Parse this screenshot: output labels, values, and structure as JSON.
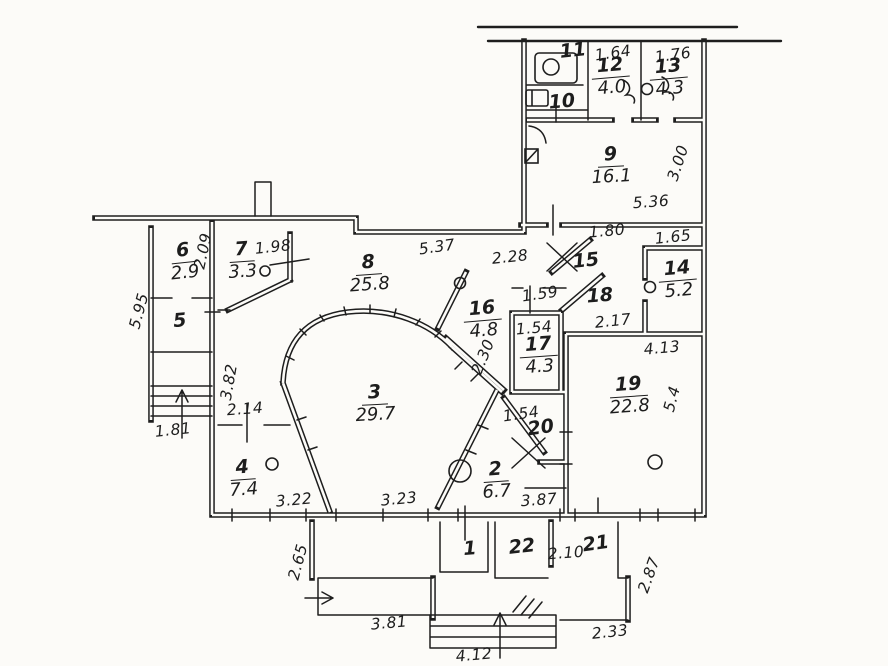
{
  "drawing": {
    "type": "apartment floor plan, hand-drawn ink on paper",
    "colors": {
      "ink": "#1e1e1e",
      "paper": "#fcfbf8"
    }
  },
  "rooms": [
    {
      "number": "1",
      "area": "",
      "x": 470,
      "y": 550,
      "rot": -4
    },
    {
      "number": "2",
      "area": "6.7",
      "x": 496,
      "y": 481,
      "rot": -4
    },
    {
      "number": "3",
      "area": "29.7",
      "x": 375,
      "y": 404,
      "rot": -3
    },
    {
      "number": "4",
      "area": "7.4",
      "x": 243,
      "y": 479,
      "rot": -4
    },
    {
      "number": "5",
      "area": "",
      "x": 180,
      "y": 322,
      "rot": -5
    },
    {
      "number": "6",
      "area": "2.9",
      "x": 184,
      "y": 262,
      "rot": -6
    },
    {
      "number": "7",
      "area": "3.3",
      "x": 242,
      "y": 261,
      "rot": -4
    },
    {
      "number": "8",
      "area": "25.8",
      "x": 369,
      "y": 274,
      "rot": -4
    },
    {
      "number": "9",
      "area": "16.1",
      "x": 611,
      "y": 166,
      "rot": -3
    },
    {
      "number": "10",
      "area": "",
      "x": 562,
      "y": 103,
      "rot": -5
    },
    {
      "number": "11",
      "area": "",
      "x": 573,
      "y": 52,
      "rot": -6
    },
    {
      "number": "12",
      "area": "4.0",
      "x": 611,
      "y": 77,
      "rot": -5
    },
    {
      "number": "13",
      "area": "4.3",
      "x": 669,
      "y": 78,
      "rot": -5
    },
    {
      "number": "14",
      "area": "5.2",
      "x": 678,
      "y": 280,
      "rot": -5
    },
    {
      "number": "15",
      "area": "",
      "x": 586,
      "y": 262,
      "rot": -6
    },
    {
      "number": "16",
      "area": "4.8",
      "x": 483,
      "y": 320,
      "rot": -5
    },
    {
      "number": "17",
      "area": "4.3",
      "x": 539,
      "y": 356,
      "rot": -4
    },
    {
      "number": "18",
      "area": "",
      "x": 600,
      "y": 297,
      "rot": -4
    },
    {
      "number": "19",
      "area": "22.8",
      "x": 629,
      "y": 396,
      "rot": -4
    },
    {
      "number": "20",
      "area": "",
      "x": 541,
      "y": 429,
      "rot": -8
    },
    {
      "number": "21",
      "area": "",
      "x": 596,
      "y": 545,
      "rot": -8
    },
    {
      "number": "22",
      "area": "",
      "x": 522,
      "y": 548,
      "rot": -6
    },
    {
      "number": "22",
      "area": "",
      "x": 0,
      "y": -99,
      "rot": 0
    }
  ],
  "dimensions": [
    {
      "text": "1.64",
      "x": 613,
      "y": 53,
      "rot": -8
    },
    {
      "text": "1.76",
      "x": 673,
      "y": 55,
      "rot": -8
    },
    {
      "text": "5.36",
      "x": 651,
      "y": 202,
      "rot": -4
    },
    {
      "text": "3.00",
      "x": 678,
      "y": 163,
      "rot": -72
    },
    {
      "text": "1.80",
      "x": 607,
      "y": 231,
      "rot": -5
    },
    {
      "text": "1.65",
      "x": 673,
      "y": 237,
      "rot": -6
    },
    {
      "text": "5.37",
      "x": 437,
      "y": 247,
      "rot": -8
    },
    {
      "text": "2.28",
      "x": 510,
      "y": 257,
      "rot": -6
    },
    {
      "text": "1.98",
      "x": 273,
      "y": 247,
      "rot": -6
    },
    {
      "text": "2.09",
      "x": 203,
      "y": 251,
      "rot": -78
    },
    {
      "text": "5.95",
      "x": 139,
      "y": 311,
      "rot": -75
    },
    {
      "text": "3.82",
      "x": 229,
      "y": 382,
      "rot": -80
    },
    {
      "text": "1.81",
      "x": 173,
      "y": 430,
      "rot": -6
    },
    {
      "text": "2.14",
      "x": 245,
      "y": 409,
      "rot": -4
    },
    {
      "text": "3.22",
      "x": 294,
      "y": 500,
      "rot": -5
    },
    {
      "text": "3.23",
      "x": 399,
      "y": 499,
      "rot": -5
    },
    {
      "text": "1.59",
      "x": 540,
      "y": 294,
      "rot": -8
    },
    {
      "text": "1.54",
      "x": 534,
      "y": 328,
      "rot": -5
    },
    {
      "text": "2.30",
      "x": 483,
      "y": 357,
      "rot": -68
    },
    {
      "text": "2.17",
      "x": 613,
      "y": 321,
      "rot": -6
    },
    {
      "text": "4.13",
      "x": 662,
      "y": 348,
      "rot": -5
    },
    {
      "text": "5.4",
      "x": 672,
      "y": 399,
      "rot": -75
    },
    {
      "text": "1.54",
      "x": 521,
      "y": 414,
      "rot": -8
    },
    {
      "text": "3.87",
      "x": 539,
      "y": 500,
      "rot": -4
    },
    {
      "text": "2.10",
      "x": 566,
      "y": 553,
      "rot": -4
    },
    {
      "text": "2.87",
      "x": 649,
      "y": 575,
      "rot": -70
    },
    {
      "text": "2.33",
      "x": 610,
      "y": 632,
      "rot": -6
    },
    {
      "text": "4.12",
      "x": 474,
      "y": 655,
      "rot": -5
    },
    {
      "text": "3.81",
      "x": 389,
      "y": 623,
      "rot": -5
    },
    {
      "text": "2.65",
      "x": 298,
      "y": 562,
      "rot": -75
    }
  ],
  "symbols": [
    "sink-icon",
    "toilet-icon",
    "door-swing-icon",
    "door-knob-circles",
    "stair-flight-left",
    "stair-flight-bottom",
    "direction-arrows",
    "shaft-x-marks",
    "bay-window-arc",
    "hatch-marks"
  ]
}
